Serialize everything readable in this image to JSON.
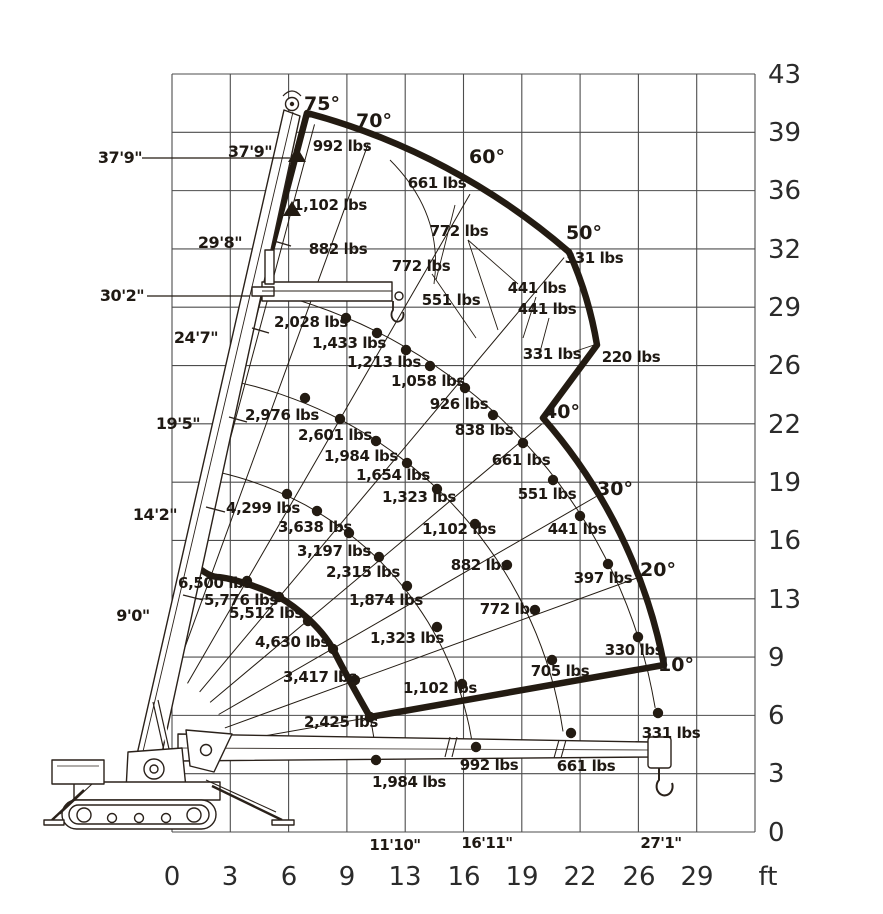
{
  "chart_data": {
    "type": "scatter",
    "title": "Mini crawler crane load capacity chart (lifting envelope)",
    "unit": "ft",
    "grid": "on",
    "x_axis": {
      "ticks": [
        "0",
        "3",
        "6",
        "9",
        "13",
        "16",
        "19",
        "22",
        "26",
        "29"
      ],
      "unit_label": "ft"
    },
    "y_axis": {
      "ticks_top_to_bottom": [
        "43",
        "39",
        "36",
        "32",
        "29",
        "26",
        "22",
        "19",
        "16",
        "13",
        "9",
        "6",
        "3",
        "0"
      ]
    },
    "boom_angles_deg": [
      75,
      70,
      60,
      50,
      40,
      30,
      20,
      10
    ],
    "radius_markers": [
      "11'10\"",
      "16'11\"",
      "27'1\""
    ],
    "boom_extension_marks": [
      "9'0\"",
      "14'2\"",
      "19'5\"",
      "24'7\"",
      "29'8\""
    ],
    "height_marks": [
      "37'9\"",
      "30'2\""
    ],
    "series": [
      {
        "name": "outer-boundary-full-extension",
        "loads": [
          "992 lbs",
          "661 lbs",
          "331 lbs",
          "220 lbs"
        ]
      },
      {
        "name": "jib-searcher-hook",
        "loads": [
          "1,102 lbs",
          "882 lbs",
          "772 lbs",
          "772 lbs",
          "551 lbs",
          "441 lbs",
          "441 lbs",
          "331 lbs"
        ]
      },
      {
        "name": "arc-extension-4",
        "loads": [
          "2,028 lbs",
          "1,433 lbs",
          "1,213 lbs",
          "1,058 lbs",
          "926 lbs",
          "838 lbs",
          "661 lbs",
          "551 lbs",
          "441 lbs",
          "397 lbs",
          "330 lbs",
          "331 lbs"
        ]
      },
      {
        "name": "arc-extension-3",
        "loads": [
          "2,976 lbs",
          "2,601 lbs",
          "1,984 lbs",
          "1,654 lbs",
          "1,323 lbs",
          "1,102 lbs",
          "882 lbs",
          "772 lbs",
          "705 lbs",
          "661 lbs"
        ]
      },
      {
        "name": "arc-extension-2",
        "loads": [
          "4,299 lbs",
          "3,638 lbs",
          "3,197 lbs",
          "2,315 lbs",
          "1,874 lbs",
          "1,323 lbs",
          "1,102 lbs",
          "992 lbs"
        ]
      },
      {
        "name": "minimum-radius-boundary",
        "loads": [
          "6,500 lbs",
          "5,776 lbs",
          "5,512 lbs",
          "4,630 lbs",
          "3,417 lbs",
          "2,425 lbs",
          "1,984 lbs"
        ]
      }
    ]
  },
  "render": {
    "ink": "#231b12",
    "grid_color": "#4d4d4d",
    "grid": {
      "x0": 172,
      "y0": 74,
      "x1": 755,
      "y1": 832,
      "cols": 10,
      "rows": 13
    },
    "pivot": [
      145,
      757
    ],
    "x_tick_y": 876,
    "x_ticks": [
      {
        "t": "0",
        "x": 172
      },
      {
        "t": "3",
        "x": 230
      },
      {
        "t": "6",
        "x": 289
      },
      {
        "t": "9",
        "x": 347
      },
      {
        "t": "13",
        "x": 405
      },
      {
        "t": "16",
        "x": 464
      },
      {
        "t": "19",
        "x": 522
      },
      {
        "t": "22",
        "x": 580
      },
      {
        "t": "26",
        "x": 639
      },
      {
        "t": "29",
        "x": 697
      }
    ],
    "unit_pos": [
      768,
      876
    ],
    "y_ticks": [
      {
        "t": "43",
        "y": 74
      },
      {
        "t": "39",
        "y": 132
      },
      {
        "t": "36",
        "y": 190
      },
      {
        "t": "32",
        "y": 249
      },
      {
        "t": "29",
        "y": 307
      },
      {
        "t": "26",
        "y": 365
      },
      {
        "t": "22",
        "y": 424
      },
      {
        "t": "19",
        "y": 482
      },
      {
        "t": "16",
        "y": 540
      },
      {
        "t": "13",
        "y": 599
      },
      {
        "t": "9",
        "y": 657
      },
      {
        "t": "6",
        "y": 715
      },
      {
        "t": "3",
        "y": 773
      },
      {
        "t": "0",
        "y": 832
      }
    ],
    "y_tick_x": 768,
    "radials": [
      {
        "a": 75,
        "r1": 85,
        "r2": 655
      },
      {
        "a": 70,
        "r1": 85,
        "r2": 652
      },
      {
        "a": 60,
        "r1": 85,
        "r2": 650
      },
      {
        "a": 50,
        "r1": 85,
        "r2": 652
      },
      {
        "a": 40,
        "r1": 85,
        "r2": 518
      },
      {
        "a": 30,
        "r1": 85,
        "r2": 521
      },
      {
        "a": 20,
        "r1": 85,
        "r2": 523
      },
      {
        "a": 10,
        "r1": 85,
        "r2": 519
      }
    ],
    "arc_k": 36,
    "arcs": [
      {
        "r0": 293,
        "a_start": 75.5,
        "a_end": 1.5
      },
      {
        "r0": 385,
        "a_start": 75.5,
        "a_end": 2.5
      },
      {
        "r0": 480,
        "a_start": 75.5,
        "a_end": 4.5
      }
    ],
    "min_tail": "M370,717 Q375,740 376,758",
    "envelope_path": "M307,113 A660,660 0 0 1 569,252 C583,283 592,315 597,345 L543,418 A524,524 0 0 1 664,665 L370,717 C358,696 344,671 333,649 C320,626 296,607 279,597 C263,588 232,578 217,577 C207,576 196,566 190,560 L307,113 Z",
    "dots": {
      "arc4": [
        [
          346,
          318
        ],
        [
          377,
          333
        ],
        [
          406,
          350
        ],
        [
          430,
          366
        ],
        [
          465,
          388
        ],
        [
          493,
          415
        ],
        [
          523,
          443
        ],
        [
          553,
          480
        ],
        [
          580,
          516
        ],
        [
          608,
          564
        ],
        [
          638,
          637
        ],
        [
          658,
          713
        ]
      ],
      "arc3": [
        [
          305,
          398
        ],
        [
          340,
          419
        ],
        [
          376,
          441
        ],
        [
          407,
          463
        ],
        [
          437,
          489
        ],
        [
          475,
          524
        ],
        [
          507,
          565
        ],
        [
          535,
          610
        ],
        [
          552,
          660
        ],
        [
          571,
          733
        ]
      ],
      "arc2": [
        [
          287,
          494
        ],
        [
          317,
          511
        ],
        [
          349,
          533
        ],
        [
          379,
          557
        ],
        [
          407,
          586
        ],
        [
          437,
          627
        ],
        [
          462,
          684
        ],
        [
          476,
          747
        ]
      ],
      "min": [
        [
          247,
          581
        ],
        [
          279,
          597
        ],
        [
          308,
          621
        ],
        [
          333,
          649
        ],
        [
          355,
          680
        ],
        [
          370,
          717
        ],
        [
          376,
          760
        ]
      ]
    },
    "capacity_labels": [
      {
        "t": "992 lbs",
        "x": 342,
        "y": 146
      },
      {
        "t": "661 lbs",
        "x": 437,
        "y": 183
      },
      {
        "t": "331 lbs",
        "x": 594,
        "y": 258
      },
      {
        "t": "220 lbs",
        "x": 631,
        "y": 357
      },
      {
        "t": "1,102 lbs",
        "x": 330,
        "y": 205
      },
      {
        "t": "882 lbs",
        "x": 338,
        "y": 249
      },
      {
        "t": "772 lbs",
        "x": 459,
        "y": 231
      },
      {
        "t": "772 lbs",
        "x": 421,
        "y": 266
      },
      {
        "t": "551 lbs",
        "x": 451,
        "y": 300
      },
      {
        "t": "441 lbs",
        "x": 537,
        "y": 288
      },
      {
        "t": "441 lbs",
        "x": 547,
        "y": 309
      },
      {
        "t": "331 lbs",
        "x": 552,
        "y": 354
      },
      {
        "t": "2,028 lbs",
        "x": 311,
        "y": 322
      },
      {
        "t": "1,433 lbs",
        "x": 349,
        "y": 343
      },
      {
        "t": "1,213 lbs",
        "x": 384,
        "y": 362
      },
      {
        "t": "1,058 lbs",
        "x": 428,
        "y": 381
      },
      {
        "t": "926 lbs",
        "x": 459,
        "y": 404
      },
      {
        "t": "838 lbs",
        "x": 484,
        "y": 430
      },
      {
        "t": "661 lbs",
        "x": 521,
        "y": 460
      },
      {
        "t": "551 lbs",
        "x": 547,
        "y": 494
      },
      {
        "t": "441 lbs",
        "x": 577,
        "y": 529
      },
      {
        "t": "397 lbs",
        "x": 603,
        "y": 578
      },
      {
        "t": "330 lbs",
        "x": 634,
        "y": 650
      },
      {
        "t": "331 lbs",
        "x": 671,
        "y": 733
      },
      {
        "t": "2,976 lbs",
        "x": 282,
        "y": 415
      },
      {
        "t": "2,601 lbs",
        "x": 335,
        "y": 435
      },
      {
        "t": "1,984 lbs",
        "x": 361,
        "y": 456
      },
      {
        "t": "1,654 lbs",
        "x": 393,
        "y": 475
      },
      {
        "t": "1,323 lbs",
        "x": 419,
        "y": 497
      },
      {
        "t": "1,102 lbs",
        "x": 459,
        "y": 529
      },
      {
        "t": "882 lbs",
        "x": 480,
        "y": 565
      },
      {
        "t": "772 lbs",
        "x": 509,
        "y": 609
      },
      {
        "t": "705 lbs",
        "x": 560,
        "y": 671
      },
      {
        "t": "661 lbs",
        "x": 586,
        "y": 766
      },
      {
        "t": "4,299 lbs",
        "x": 263,
        "y": 508
      },
      {
        "t": "3,638 lbs",
        "x": 315,
        "y": 527
      },
      {
        "t": "3,197 lbs",
        "x": 334,
        "y": 551
      },
      {
        "t": "2,315 lbs",
        "x": 363,
        "y": 572
      },
      {
        "t": "1,874 lbs",
        "x": 386,
        "y": 600
      },
      {
        "t": "1,323 lbs",
        "x": 407,
        "y": 638
      },
      {
        "t": "1,102 lbs",
        "x": 440,
        "y": 688
      },
      {
        "t": "992 lbs",
        "x": 489,
        "y": 765
      },
      {
        "t": "6,500 lbs",
        "x": 215,
        "y": 583
      },
      {
        "t": "5,776 lbs",
        "x": 241,
        "y": 600
      },
      {
        "t": "5,512 lbs",
        "x": 266,
        "y": 613
      },
      {
        "t": "4,630 lbs",
        "x": 292,
        "y": 642
      },
      {
        "t": "3,417 lbs",
        "x": 320,
        "y": 677
      },
      {
        "t": "2,425 lbs",
        "x": 341,
        "y": 722
      },
      {
        "t": "1,984 lbs",
        "x": 409,
        "y": 782
      }
    ],
    "angle_labels": [
      {
        "t": "75°",
        "x": 322,
        "y": 104
      },
      {
        "t": "70°",
        "x": 374,
        "y": 121
      },
      {
        "t": "60°",
        "x": 487,
        "y": 157
      },
      {
        "t": "50°",
        "x": 584,
        "y": 233
      },
      {
        "t": "40°",
        "x": 562,
        "y": 412
      },
      {
        "t": "30°",
        "x": 615,
        "y": 489
      },
      {
        "t": "20°",
        "x": 658,
        "y": 570
      },
      {
        "t": "10°",
        "x": 676,
        "y": 665
      }
    ],
    "height_labels": [
      {
        "t": "37'9\"",
        "x": 120,
        "y": 158,
        "line": [
          142,
          158,
          290,
          158
        ]
      },
      {
        "t": "37'9\"",
        "x": 250,
        "y": 152
      },
      {
        "t": "29'8\"",
        "x": 220,
        "y": 243
      },
      {
        "t": "30'2\"",
        "x": 122,
        "y": 296,
        "line": [
          147,
          296,
          250,
          296
        ]
      },
      {
        "t": "24'7\"",
        "x": 196,
        "y": 338
      },
      {
        "t": "19'5\"",
        "x": 178,
        "y": 424
      },
      {
        "t": "14'2\"",
        "x": 155,
        "y": 515
      },
      {
        "t": "9'0\"",
        "x": 133,
        "y": 616
      }
    ],
    "radius_labels": [
      {
        "t": "11'10\"",
        "x": 395,
        "y": 845
      },
      {
        "t": "16'11\"",
        "x": 487,
        "y": 843
      },
      {
        "t": "27'1\"",
        "x": 661,
        "y": 843
      }
    ],
    "leaders": [
      [
        468,
        240,
        518,
        284
      ],
      [
        468,
        240,
        498,
        330
      ],
      [
        432,
        274,
        476,
        338
      ],
      [
        536,
        297,
        523,
        338
      ],
      [
        549,
        318,
        540,
        352
      ],
      [
        573,
        352,
        594,
        345
      ],
      [
        455,
        205,
        436,
        280
      ]
    ],
    "luff_arc": "M390,160 Q444,214 434,284",
    "tip_triangles": [
      [
        297,
        147
      ],
      [
        292,
        201
      ]
    ]
  }
}
